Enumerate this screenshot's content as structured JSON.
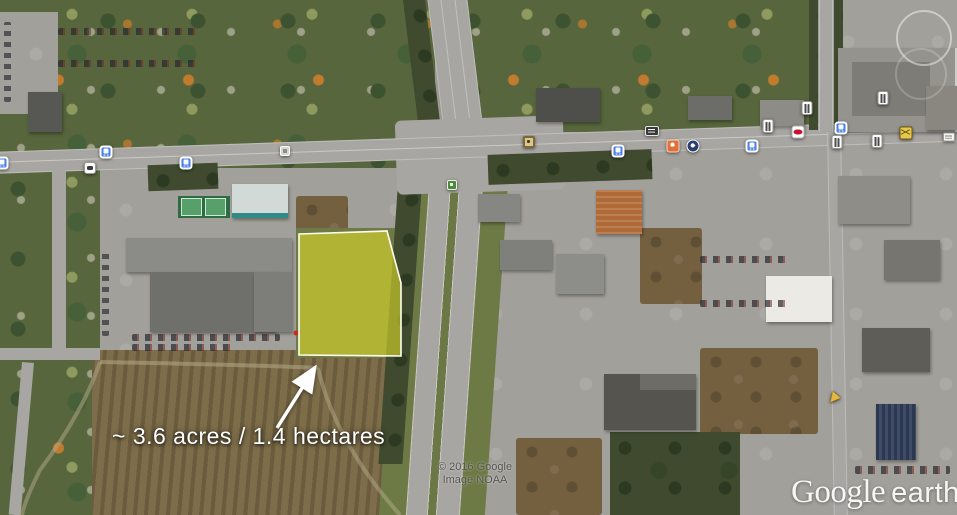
{
  "app": {
    "name": "Google Earth"
  },
  "overlay": {
    "area_annotation": "~ 3.6 acres / 1.4 hectares"
  },
  "attribution": {
    "copyright": "© 2016 Google",
    "imagery": "Image NOAA"
  },
  "logo": {
    "brand": "Google",
    "product": "earth"
  },
  "parcel": {
    "area_acres": 3.6,
    "area_hectares": 1.4,
    "fill_color": "#d8d629",
    "fill_opacity": 0.62,
    "outline_color": "#fffef0",
    "points": "299,234 387,231 401,283 401,356 299,355"
  },
  "arrow": {
    "from_x": 277,
    "from_y": 428,
    "to_x": 314,
    "to_y": 369,
    "color": "#ffffff"
  },
  "map_icons": [
    {
      "type": "transit",
      "x": 2,
      "y": 163
    },
    {
      "type": "transit",
      "x": 106,
      "y": 152
    },
    {
      "type": "vehicle",
      "x": 90,
      "y": 168
    },
    {
      "type": "transit",
      "x": 186,
      "y": 163
    },
    {
      "type": "shelter",
      "x": 285,
      "y": 151
    },
    {
      "type": "poi-yellow",
      "x": 529,
      "y": 142
    },
    {
      "type": "transit",
      "x": 618,
      "y": 151
    },
    {
      "type": "sign-dark",
      "x": 652,
      "y": 131
    },
    {
      "type": "fastfood-orange",
      "x": 673,
      "y": 146
    },
    {
      "type": "circle-navy",
      "x": 693,
      "y": 146
    },
    {
      "type": "transit",
      "x": 752,
      "y": 146
    },
    {
      "type": "restaurant",
      "x": 768,
      "y": 126
    },
    {
      "type": "donut-red",
      "x": 798,
      "y": 132
    },
    {
      "type": "transit",
      "x": 841,
      "y": 128
    },
    {
      "type": "restaurant",
      "x": 837,
      "y": 142
    },
    {
      "type": "restaurant",
      "x": 877,
      "y": 141
    },
    {
      "type": "post-yellow",
      "x": 906,
      "y": 133
    },
    {
      "type": "sign-white",
      "x": 949,
      "y": 137
    },
    {
      "type": "restaurant",
      "x": 807,
      "y": 108
    },
    {
      "type": "restaurant",
      "x": 883,
      "y": 98
    },
    {
      "type": "marker-green",
      "x": 452,
      "y": 185
    },
    {
      "type": "marker-yellow-arrow",
      "x": 833,
      "y": 399
    }
  ],
  "icon_colors": {
    "transit_blue": "#4a7fe8",
    "donut_red": "#c41230",
    "post_yellow": "#e8c84a",
    "fastfood_orange": "#e07038",
    "navy_circle": "#2a3f6e",
    "marker_green": "#4a8a3a",
    "arrow_yellow": "#e8b63a"
  }
}
